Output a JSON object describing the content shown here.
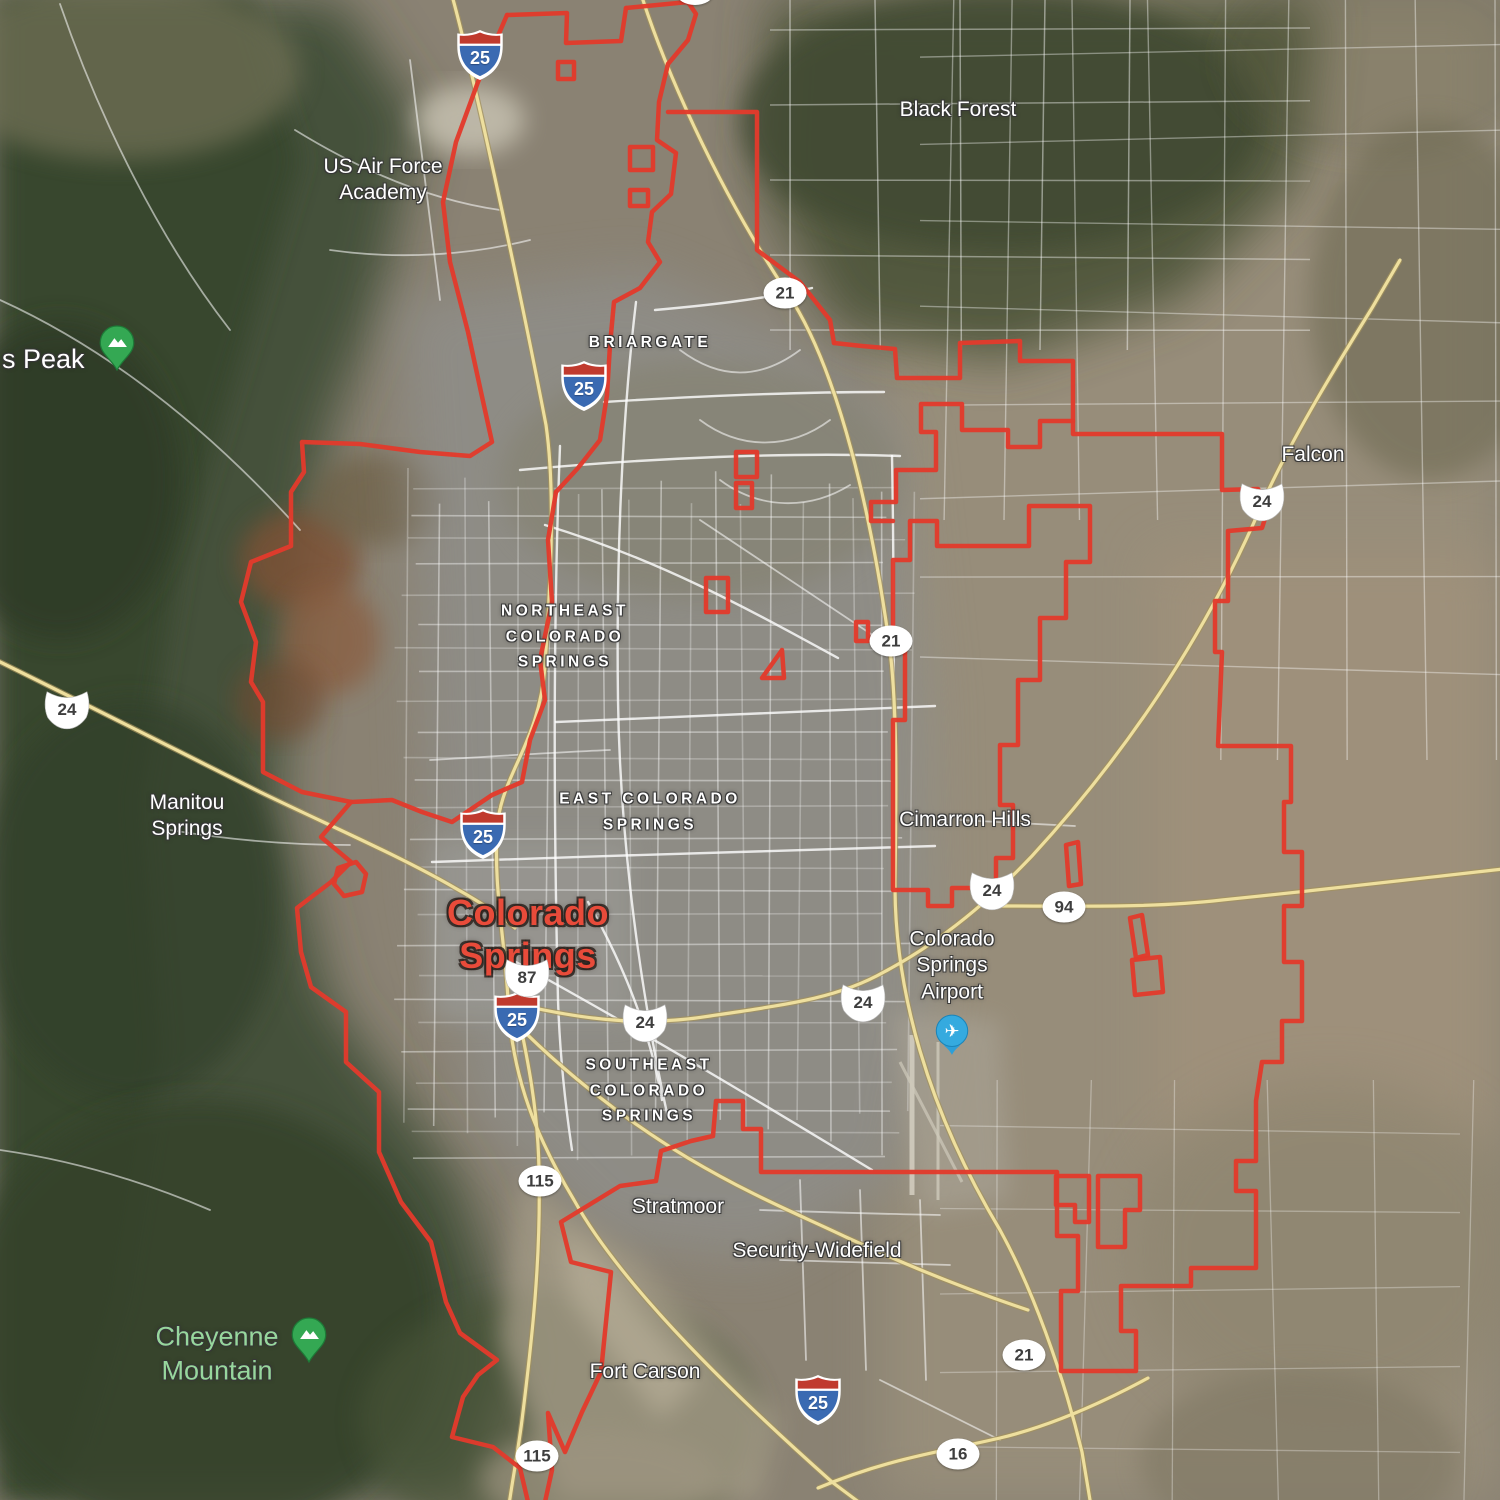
{
  "map": {
    "view_type": "satellite",
    "colors": {
      "boundary_red": "#e23a2c",
      "city_label_red": "#e84b3a",
      "place_label_white": "#ffffff",
      "park_label_green": "#97d69d",
      "highway_yellow": "#eedf9e",
      "highway_casing": "#a3925c",
      "street_white": "#ffffff"
    }
  },
  "labels": [
    {
      "id": "black-forest",
      "type": "place",
      "lines": [
        "Black Forest"
      ],
      "x": 958,
      "y": 110
    },
    {
      "id": "us-air-force-academy",
      "type": "place",
      "lines": [
        "US Air Force",
        "Academy"
      ],
      "x": 383,
      "y": 180
    },
    {
      "id": "pikes-peak",
      "type": "peak",
      "lines": [
        "s Peak"
      ],
      "x": 2,
      "y": 360
    },
    {
      "id": "briargate",
      "type": "district",
      "lines": [
        "BRIARGATE"
      ],
      "x": 650,
      "y": 343
    },
    {
      "id": "northeast-colorado-springs",
      "type": "district",
      "lines": [
        "NORTHEAST",
        "COLORADO",
        "SPRINGS"
      ],
      "x": 565,
      "y": 637
    },
    {
      "id": "falcon",
      "type": "place",
      "lines": [
        "Falcon"
      ],
      "x": 1313,
      "y": 455
    },
    {
      "id": "east-colorado-springs",
      "type": "district",
      "lines": [
        "EAST COLORADO",
        "SPRINGS"
      ],
      "x": 650,
      "y": 812
    },
    {
      "id": "manitou-springs",
      "type": "place",
      "lines": [
        "Manitou",
        "Springs"
      ],
      "x": 187,
      "y": 816
    },
    {
      "id": "cimarron-hills",
      "type": "place",
      "lines": [
        "Cimarron Hills"
      ],
      "x": 965,
      "y": 820
    },
    {
      "id": "colorado-springs-city",
      "type": "city",
      "lines": [
        "Colorado",
        "Springs"
      ],
      "x": 528,
      "y": 934
    },
    {
      "id": "colorado-springs-airport",
      "type": "place",
      "lines": [
        "Colorado",
        "Springs",
        "Airport"
      ],
      "x": 952,
      "y": 966
    },
    {
      "id": "southeast-colorado-springs",
      "type": "district",
      "lines": [
        "SOUTHEAST",
        "COLORADO",
        "SPRINGS"
      ],
      "x": 649,
      "y": 1091
    },
    {
      "id": "stratmoor",
      "type": "place",
      "lines": [
        "Stratmoor"
      ],
      "x": 678,
      "y": 1207
    },
    {
      "id": "security-widefield",
      "type": "place",
      "lines": [
        "Security-Widefield"
      ],
      "x": 817,
      "y": 1251
    },
    {
      "id": "cheyenne-mountain",
      "type": "park2",
      "lines": [
        "Cheyenne",
        "Mountain"
      ],
      "x": 217,
      "y": 1354
    },
    {
      "id": "fort-carson",
      "type": "place",
      "lines": [
        "Fort Carson"
      ],
      "x": 645,
      "y": 1372
    }
  ],
  "shields": [
    {
      "type": "interstate",
      "number": "25",
      "x": 480,
      "y": 55
    },
    {
      "type": "interstate",
      "number": "25",
      "x": 584,
      "y": 386
    },
    {
      "type": "interstate",
      "number": "25",
      "x": 483,
      "y": 834
    },
    {
      "type": "interstate",
      "number": "25",
      "x": 517,
      "y": 1017
    },
    {
      "type": "interstate",
      "number": "25",
      "x": 818,
      "y": 1400
    },
    {
      "type": "us",
      "number": "24",
      "x": 67,
      "y": 710
    },
    {
      "type": "us",
      "number": "24",
      "x": 1262,
      "y": 502
    },
    {
      "type": "us",
      "number": "24",
      "x": 992,
      "y": 891
    },
    {
      "type": "us",
      "number": "24",
      "x": 863,
      "y": 1003
    },
    {
      "type": "us",
      "number": "24",
      "x": 645,
      "y": 1023
    },
    {
      "type": "us",
      "number": "87",
      "x": 527,
      "y": 978
    },
    {
      "type": "circle",
      "number": "21",
      "x": 785,
      "y": 293
    },
    {
      "type": "circle",
      "number": "21",
      "x": 891,
      "y": 641
    },
    {
      "type": "circle",
      "number": "21",
      "x": 1024,
      "y": 1355
    },
    {
      "type": "circle",
      "number": "94",
      "x": 1064,
      "y": 907
    },
    {
      "type": "circle",
      "number": "115",
      "x": 540,
      "y": 1181
    },
    {
      "type": "circle",
      "number": "115",
      "x": 537,
      "y": 1456
    },
    {
      "type": "circle",
      "number": "16",
      "x": 958,
      "y": 1454
    }
  ],
  "markers": [
    {
      "type": "mountain-pin",
      "x": 117,
      "y": 376
    },
    {
      "type": "mountain-pin",
      "x": 309,
      "y": 1368
    },
    {
      "type": "airport-pin",
      "x": 952,
      "y": 1062
    }
  ],
  "partial_shield": {
    "x": 695,
    "y": -6
  },
  "boundary": {
    "stroke_width": 4.5,
    "paths": [
      "M 626,8 L 688,2 696,14 688,40 668,64 659,102 657,140 676,153 671,194 652,212 648,242 660,262 640,288 614,302 610,345 607,395 600,440 578,468 556,492",
      "M 556,492 L 548,540 552,602 540,660 545,700 530,740 522,782 492,795 452,822 422,812 392,800 351,802",
      "M 507,15 L 478,82 456,142 443,202 450,262 468,332 481,392 492,442 470,456 420,452 360,444 302,442 304,472 291,492 291,546 251,562 241,602 256,642 251,682 263,702 263,772 302,792 351,802",
      "M 626,8 L 621,41 566,43 567,13 507,15",
      "M 351,802 L 321,837 351,862 331,882 297,908 301,952 311,987 346,1012 346,1062 379,1092 379,1152 401,1202 431,1242 446,1302 460,1333 497,1360 478,1375 463,1397 452,1437 493,1447 520,1468 528,1502",
      "M 668,112 L 757,112 757,250 800,282 830,320 834,343",
      "M 834,343 L 862,346 895,349 897,378 960,378 960,343 1020,341 1020,361 1073,361 1073,434 1222,434 1222,490 1258,489 1269,506 1262,528 1228,531 1228,601 1215,601 1215,652 1222,652 1218,746 1291,746 1291,802 1284,802 1284,852 1302,852 1302,906 1284,906 1284,962 1302,962 1302,1021 1282,1021 1282,1062 1262,1062 1256,1101 1256,1161 1236,1161 1236,1191 1256,1191 1256,1268 1191,1268 1191,1286 1121,1286 1121,1331 1136,1331 1136,1371 1061,1371 1061,1291 1078,1291 1078,1236 1057,1236 1057,1172 761,1172 761,1129 743,1129 743,1101 716,1101 713,1136 691,1141 661,1151 656,1181 620,1186 561,1222 571,1262 611,1272 601,1372 582,1412 565,1452 548,1413 552,1470 545,1502",
      "M 937,546 L 937,521 910,521 910,560 893,560 893,640 905,640 905,720 893,720 893,890 928,890 928,906 952,906 952,888 996,888 996,858 1013,858 1013,805 1000,805 1000,745 1018,745 1018,680 1040,680 1040,618 1066,618 1066,562 1090,562 1090,506 1029,506 1029,546 937,546 Z",
      "M 893,521 L 871,521 871,502 896,502 896,470 936,470 936,432 921,432 921,404 962,404 962,430 1008,430 1008,447 1040,447 1040,421 1073,421",
      "M 558,62 L 574,62 574,79 558,79 Z",
      "M 630,147 L 653,147 653,170 630,170 Z",
      "M 630,190 L 648,190 648,206 630,206 Z",
      "M 736,452 L 757,452 757,477 736,477 Z",
      "M 736,483 L 752,483 752,508 736,508 Z",
      "M 706,578 L 728,578 728,612 706,612 Z",
      "M 762,678 L 782,650 784,678 Z",
      "M 856,622 L 868,622 868,641 856,641 Z",
      "M 1066,845 L 1078,842 1081,884 1069,886 Z",
      "M 1130,918 L 1142,915 1148,955 1136,958 Z",
      "M 1132,960 L 1160,957 1163,992 1135,995 Z",
      "M 338,868 L 356,862 366,874 362,892 344,896 334,884 Z",
      "M 1056,1176 L 1089,1176 1089,1222 1075,1222 1075,1205 1056,1205 Z",
      "M 1098,1176 L 1140,1176 1140,1210 1125,1210 1125,1247 1098,1247 Z"
    ]
  },
  "highways": [
    {
      "id": "i25",
      "d": "M 451,-8 C 473,70 522,300 546,425 C 556,495 550,590 545,665 C 540,740 505,770 498,820 C 492,880 505,940 508,1000 C 512,1080 538,1140 574,1200 C 624,1290 742,1402 832,1482 L 872,1512"
    },
    {
      "id": "co21-powers",
      "d": "M 641,-6 C 662,60 712,180 788,294 C 840,372 872,520 889,642 C 898,710 896,800 895,880 C 894,990 928,1110 1000,1230 C 1032,1288 1062,1370 1082,1452 L 1092,1512"
    },
    {
      "id": "us24-west",
      "d": "M -8,658 C 90,706 180,752 260,792 C 330,826 400,856 455,888 C 480,902 500,915 515,928"
    },
    {
      "id": "us24-east",
      "d": "M 508,1002 C 590,1022 648,1026 710,1016 C 790,1004 838,998 884,972 C 944,940 992,898 1032,856 C 1122,758 1204,640 1262,504 C 1290,442 1330,376 1372,308 L 1400,260"
    },
    {
      "id": "co94",
      "d": "M 1002,906 C 1082,906 1152,908 1222,900 C 1322,890 1422,878 1512,868"
    },
    {
      "id": "co115",
      "d": "M 516,1004 C 528,1060 538,1110 539,1170 C 541,1260 532,1340 522,1420 C 518,1452 512,1482 508,1512"
    },
    {
      "id": "co16",
      "d": "M 818,1488 C 890,1458 940,1452 1000,1438 C 1050,1426 1100,1404 1148,1378"
    },
    {
      "id": "hwy85-87",
      "d": "M 505,1012 C 560,1070 625,1120 688,1158 C 752,1196 800,1215 848,1238 C 908,1266 968,1290 1028,1310"
    }
  ]
}
